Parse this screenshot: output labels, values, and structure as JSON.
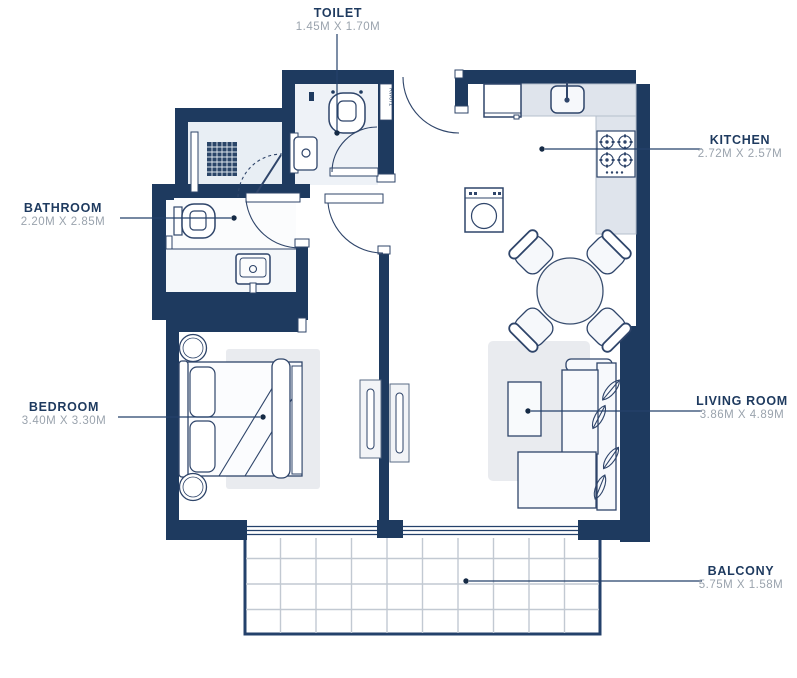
{
  "plan": {
    "type": "apartment-floor-plan",
    "colors": {
      "wall": "#1e3a5f",
      "furniture_outline": "#2f456a",
      "label_title": "#1e3a5f",
      "label_dims": "#9aa3ad",
      "counter": "#dfe4ec",
      "rug": "#e9ebef",
      "shower_floor": "#e8eef4",
      "toilet_floor": "#eef2f7",
      "balcony_grid": "#c2c9d2"
    },
    "labels": {
      "toilet": {
        "name": "TOILET",
        "dims": "1.45M X 1.70M"
      },
      "kitchen": {
        "name": "KITCHEN",
        "dims": "2.72M X 2.57M"
      },
      "bathroom": {
        "name": "BATHROOM",
        "dims": "2.20M X 2.85M"
      },
      "bedroom": {
        "name": "BEDROOM",
        "dims": "3.40M X 3.30M"
      },
      "living_room": {
        "name": "LIVING ROOM",
        "dims": "3.86M X 4.89M"
      },
      "balcony": {
        "name": "BALCONY",
        "dims": "5.75M X 1.58M"
      }
    },
    "shaft_label": "RW071"
  }
}
